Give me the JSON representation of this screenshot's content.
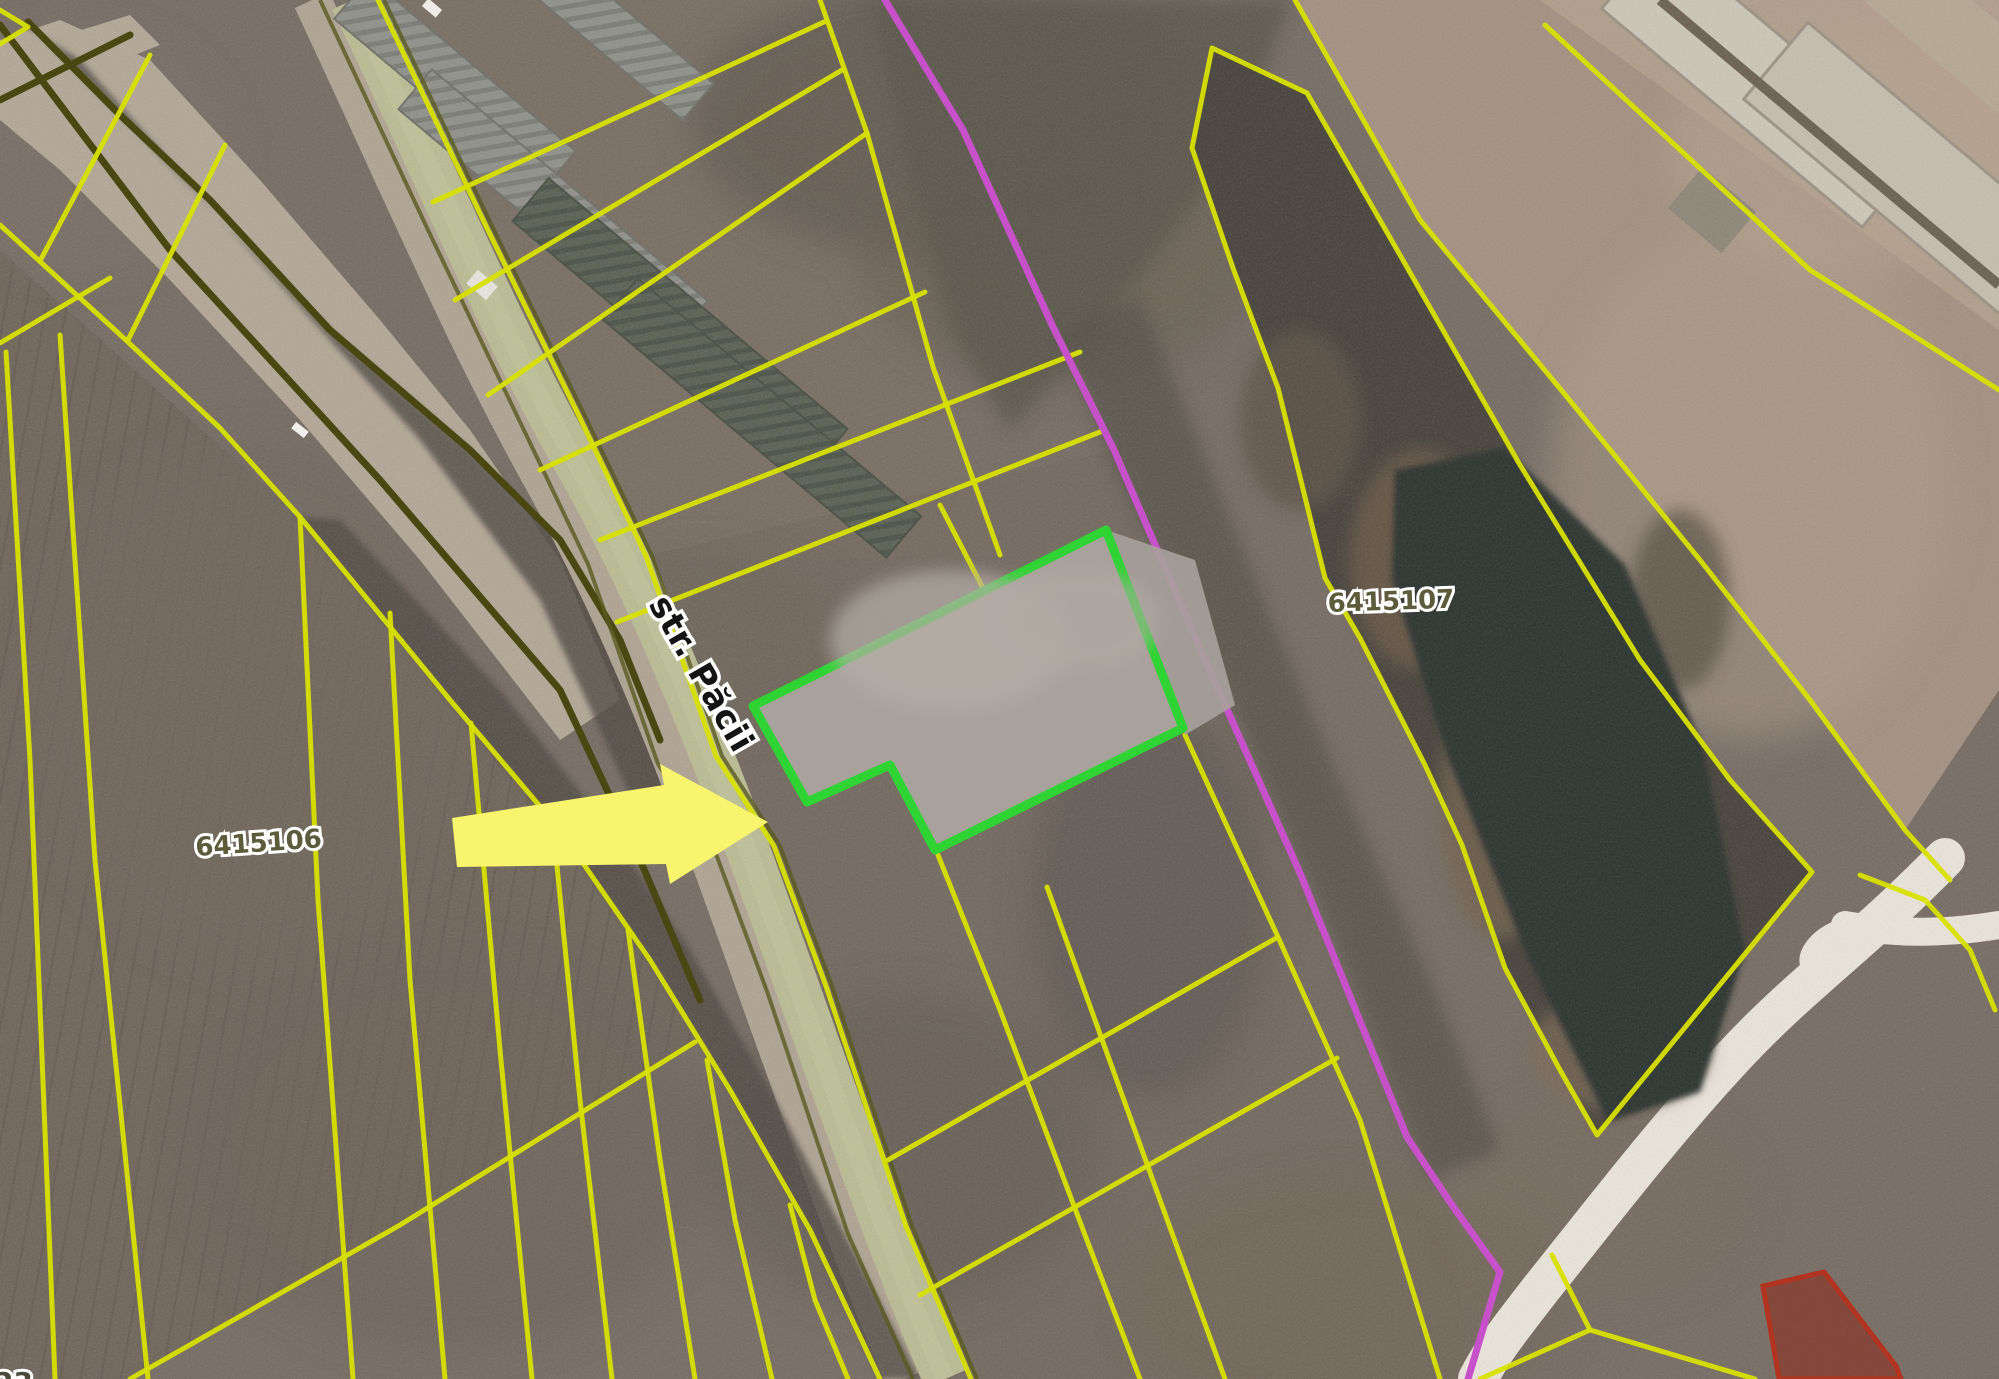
{
  "map_view": {
    "labels": {
      "parcel_field": {
        "text": "6415106"
      },
      "parcel_pond": {
        "text": "6415107"
      },
      "street": {
        "text": "str. Păcii"
      },
      "edge_partial": {
        "text": "23"
      }
    },
    "annotations": {
      "arrow": {
        "shape": "arrow-right",
        "points_at": "selected-parcel-on-str-pacii"
      }
    },
    "colors": {
      "cadastral_line": "#D9E000",
      "selected_parcel": "#2FD434",
      "route_line": "#C751C9",
      "annotation_arrow": "#F8F46E",
      "restricted_stroke": "#B23320",
      "restricted_fill": "#8C2817",
      "label_olive": "#5C5C3D",
      "street_label": "#141414",
      "label_halo": "#FFFFFF",
      "terrain": "#756B62",
      "field_dark": "#6E6459",
      "field_tan": "#A39080",
      "field_tan_light": "#B19D8B",
      "road_strip": "#B9BC92",
      "track": "#B3A796",
      "white_road": "#EAE4DA",
      "olive_dark": "#4B4712",
      "scrub": "#4F4942",
      "pond": "#2C332E",
      "marsh": "#6B5948",
      "gray_lot": "#A9A29C",
      "building": "#CDC6B8",
      "greenhouse": "#8F9089",
      "greenhouse_dark": "#596052"
    }
  }
}
